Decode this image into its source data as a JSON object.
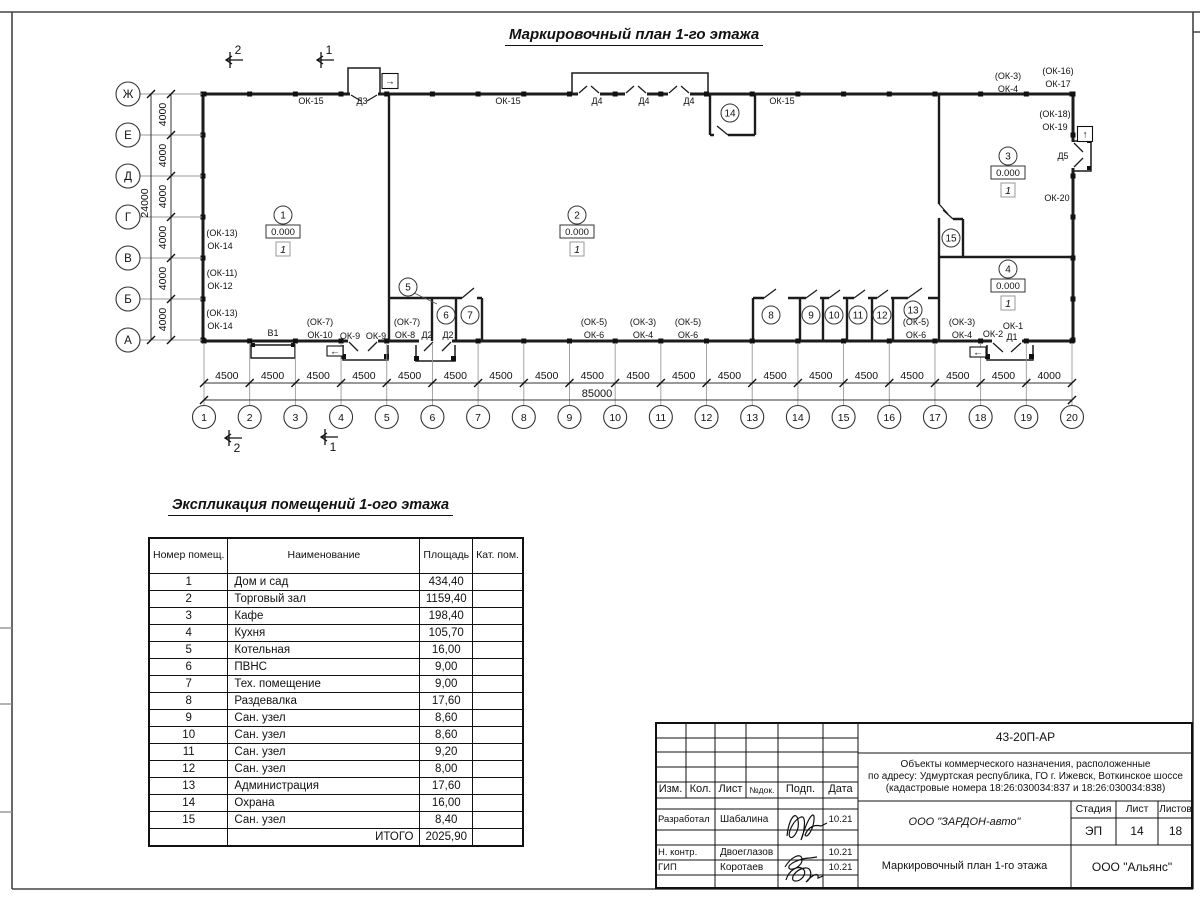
{
  "doc_title": "Маркировочный план 1-го этажа",
  "plan": {
    "grid": {
      "columns": [
        "1",
        "2",
        "3",
        "4",
        "5",
        "6",
        "7",
        "8",
        "9",
        "10",
        "11",
        "12",
        "13",
        "14",
        "15",
        "16",
        "17",
        "18",
        "19",
        "20"
      ],
      "column_dims": [
        "4500",
        "4500",
        "4500",
        "4500",
        "4500",
        "4500",
        "4500",
        "4500",
        "4500",
        "4500",
        "4500",
        "4500",
        "4500",
        "4500",
        "4500",
        "4500",
        "4500",
        "4500",
        "4000"
      ],
      "total_width_label": "85000",
      "rows": [
        "Ж",
        "Е",
        "Д",
        "Г",
        "В",
        "Б",
        "А"
      ],
      "row_dims": [
        "4000",
        "4000",
        "4000",
        "4000",
        "4000",
        "4000"
      ],
      "total_height_label": "24000"
    },
    "section_markers": [
      {
        "n": "2",
        "x": 226,
        "y": 60,
        "pos": "top"
      },
      {
        "n": "1",
        "x": 317,
        "y": 60,
        "pos": "top"
      },
      {
        "n": "2",
        "x": 225,
        "y": 438,
        "pos": "bottom"
      },
      {
        "n": "1",
        "x": 321,
        "y": 437,
        "pos": "bottom"
      }
    ],
    "room_markers": [
      {
        "num": "1",
        "x": 283,
        "y": 215,
        "elevation": "0.000",
        "category": "1"
      },
      {
        "num": "2",
        "x": 577,
        "y": 215,
        "elevation": "0.000",
        "category": "1"
      },
      {
        "num": "3",
        "x": 1008,
        "y": 156,
        "elevation": "0.000",
        "category": "1"
      },
      {
        "num": "4",
        "x": 1008,
        "y": 269,
        "elevation": "0.000",
        "category": "1"
      },
      {
        "num": "5",
        "x": 408,
        "y": 287,
        "leader": [
          414,
          293,
          437,
          304
        ]
      },
      {
        "num": "6",
        "x": 446,
        "y": 315
      },
      {
        "num": "7",
        "x": 470,
        "y": 315
      },
      {
        "num": "8",
        "x": 771,
        "y": 315
      },
      {
        "num": "9",
        "x": 811,
        "y": 315
      },
      {
        "num": "10",
        "x": 834,
        "y": 315
      },
      {
        "num": "11",
        "x": 858,
        "y": 315
      },
      {
        "num": "12",
        "x": 882,
        "y": 315
      },
      {
        "num": "13",
        "x": 913,
        "y": 310
      },
      {
        "num": "14",
        "x": 730,
        "y": 113
      },
      {
        "num": "15",
        "x": 951,
        "y": 238
      }
    ],
    "labels": [
      {
        "t": "ОК-15",
        "x": 311,
        "y": 104
      },
      {
        "t": "Д3",
        "x": 362,
        "y": 104
      },
      {
        "t": "ОК-15",
        "x": 508,
        "y": 104
      },
      {
        "t": "Д4",
        "x": 597,
        "y": 104
      },
      {
        "t": "Д4",
        "x": 644,
        "y": 104
      },
      {
        "t": "Д4",
        "x": 689,
        "y": 104
      },
      {
        "t": "ОК-15",
        "x": 782,
        "y": 104
      },
      {
        "t": "(ОК-3)",
        "x": 1008,
        "y": 79
      },
      {
        "t": "ОК-4",
        "x": 1008,
        "y": 92
      },
      {
        "t": "(ОК-16)",
        "x": 1058,
        "y": 74
      },
      {
        "t": "ОК-17",
        "x": 1058,
        "y": 87
      },
      {
        "t": "(ОК-18)",
        "x": 1055,
        "y": 117
      },
      {
        "t": "ОК-19",
        "x": 1055,
        "y": 130
      },
      {
        "t": "Д5",
        "x": 1063,
        "y": 159
      },
      {
        "t": "ОК-20",
        "x": 1057,
        "y": 201
      },
      {
        "t": "(ОК-13)",
        "x": 222,
        "y": 236
      },
      {
        "t": "ОК-14",
        "x": 220,
        "y": 249
      },
      {
        "t": "(ОК-11)",
        "x": 222,
        "y": 276
      },
      {
        "t": "ОК-12",
        "x": 220,
        "y": 289
      },
      {
        "t": "(ОК-13)",
        "x": 222,
        "y": 316
      },
      {
        "t": "ОК-14",
        "x": 220,
        "y": 329
      },
      {
        "t": "В1",
        "x": 273,
        "y": 336
      },
      {
        "t": "(ОК-7)",
        "x": 320,
        "y": 325
      },
      {
        "t": "ОК-10",
        "x": 320,
        "y": 338
      },
      {
        "t": "ОК-9",
        "x": 350,
        "y": 339
      },
      {
        "t": "ОК-9",
        "x": 376,
        "y": 339
      },
      {
        "t": "(ОК-7)",
        "x": 407,
        "y": 325
      },
      {
        "t": "ОК-8",
        "x": 405,
        "y": 338
      },
      {
        "t": "Д2",
        "x": 427,
        "y": 338
      },
      {
        "t": "Д2",
        "x": 448,
        "y": 338
      },
      {
        "t": "(ОК-5)",
        "x": 594,
        "y": 325
      },
      {
        "t": "ОК-6",
        "x": 594,
        "y": 338
      },
      {
        "t": "(ОК-3)",
        "x": 643,
        "y": 325
      },
      {
        "t": "ОК-4",
        "x": 643,
        "y": 338
      },
      {
        "t": "(ОК-5)",
        "x": 688,
        "y": 325
      },
      {
        "t": "ОК-6",
        "x": 688,
        "y": 338
      },
      {
        "t": "(ОК-5)",
        "x": 916,
        "y": 325
      },
      {
        "t": "ОК-6",
        "x": 916,
        "y": 338
      },
      {
        "t": "(ОК-3)",
        "x": 962,
        "y": 325
      },
      {
        "t": "ОК-4",
        "x": 962,
        "y": 338
      },
      {
        "t": "ОК-2",
        "x": 993,
        "y": 337
      },
      {
        "t": "ОК-1",
        "x": 1013,
        "y": 329
      },
      {
        "t": "Д1",
        "x": 1012,
        "y": 340
      }
    ],
    "entrance_arrows": [
      {
        "icon": "→",
        "x": 390,
        "y": 81,
        "w": 16,
        "h": 15
      },
      {
        "icon": "↑",
        "x": 1085,
        "y": 134,
        "w": 15,
        "h": 15
      },
      {
        "icon": "←",
        "x": 335,
        "y": 351,
        "w": 16,
        "h": 10
      },
      {
        "icon": "←",
        "x": 978,
        "y": 352,
        "w": 16,
        "h": 10
      }
    ]
  },
  "explication": {
    "title": "Экспликация помещений 1-ого этажа",
    "columns": [
      "Номер помещ.",
      "Наименование",
      "Площадь",
      "Кат. пом."
    ],
    "rows": [
      [
        "1",
        "Дом и сад",
        "434,40"
      ],
      [
        "2",
        "Торговый зал",
        "1159,40"
      ],
      [
        "3",
        "Кафе",
        "198,40"
      ],
      [
        "4",
        "Кухня",
        "105,70"
      ],
      [
        "5",
        "Котельная",
        "16,00"
      ],
      [
        "6",
        "ПВНС",
        "9,00"
      ],
      [
        "7",
        "Тех. помещение",
        "9,00"
      ],
      [
        "8",
        "Раздевалка",
        "17,60"
      ],
      [
        "9",
        "Сан. узел",
        "8,60"
      ],
      [
        "10",
        "Сан. узел",
        "8,60"
      ],
      [
        "11",
        "Сан. узел",
        "9,20"
      ],
      [
        "12",
        "Сан. узел",
        "8,00"
      ],
      [
        "13",
        "Администрация",
        "17,60"
      ],
      [
        "14",
        "Охрана",
        "16,00"
      ],
      [
        "15",
        "Сан. узел",
        "8,40"
      ]
    ],
    "total_label": "ИТОГО",
    "total_value": "2025,90"
  },
  "stamp": {
    "code": "43-20П-АР",
    "address1": "Объекты коммерческого назначения, расположенные",
    "address2": "по адресу: Удмуртская республика, ГО г. Ижевск, Воткинское шоссе",
    "address3": "(кадастровые номера 18:26:030034:837 и 18:26:030034:838)",
    "cols": {
      "izm": "Изм.",
      "kol": "Кол.",
      "list": "Лист",
      "ndok": "№док.",
      "podp": "Подп.",
      "data": "Дата"
    },
    "sign_rows": [
      {
        "role": "Разработал",
        "name": "Шабалина",
        "date": "10.21"
      },
      {
        "role": "Н. контр.",
        "name": "Двоеглазов",
        "date": "10.21"
      },
      {
        "role": "ГИП",
        "name": "Коротаев",
        "date": "10.21"
      }
    ],
    "company": "ООО \"ЗАРДОН-авто\"",
    "stage_label": "Стадия",
    "sheet_label": "Лист",
    "sheets_label": "Листов",
    "stage": "ЭП",
    "sheet": "14",
    "sheets": "18",
    "drawing_title": "Маркировочный план 1-го этажа",
    "org": "ООО \"Альянс\""
  }
}
